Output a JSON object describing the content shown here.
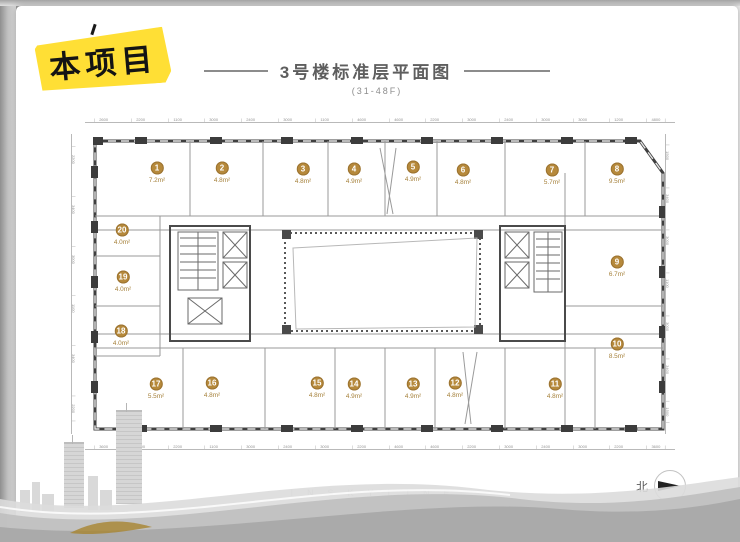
{
  "badge": {
    "label": "本项目"
  },
  "header": {
    "title": "3号楼标准层平面图",
    "subtitle": "(31-48F)"
  },
  "plan": {
    "units": [
      {
        "no": "1",
        "area": "7.2m²",
        "x": 157,
        "y": 169
      },
      {
        "no": "2",
        "area": "4.8m²",
        "x": 222,
        "y": 169
      },
      {
        "no": "3",
        "area": "4.8m²",
        "x": 303,
        "y": 170
      },
      {
        "no": "4",
        "area": "4.9m²",
        "x": 354,
        "y": 170
      },
      {
        "no": "5",
        "area": "4.9m²",
        "x": 413,
        "y": 168
      },
      {
        "no": "6",
        "area": "4.8m²",
        "x": 463,
        "y": 171
      },
      {
        "no": "7",
        "area": "5.7m²",
        "x": 552,
        "y": 171
      },
      {
        "no": "8",
        "area": "9.5m²",
        "x": 617,
        "y": 170
      },
      {
        "no": "9",
        "area": "6.7m²",
        "x": 617,
        "y": 263
      },
      {
        "no": "10",
        "area": "8.5m²",
        "x": 617,
        "y": 345
      },
      {
        "no": "11",
        "area": "4.8m²",
        "x": 555,
        "y": 385
      },
      {
        "no": "12",
        "area": "4.8m²",
        "x": 455,
        "y": 384
      },
      {
        "no": "13",
        "area": "4.9m²",
        "x": 413,
        "y": 385
      },
      {
        "no": "14",
        "area": "4.9m²",
        "x": 354,
        "y": 385
      },
      {
        "no": "15",
        "area": "4.8m²",
        "x": 317,
        "y": 384
      },
      {
        "no": "16",
        "area": "4.8m²",
        "x": 212,
        "y": 384
      },
      {
        "no": "17",
        "area": "5.5m²",
        "x": 156,
        "y": 385
      },
      {
        "no": "18",
        "area": "4.0m²",
        "x": 121,
        "y": 332
      },
      {
        "no": "19",
        "area": "4.0m²",
        "x": 123,
        "y": 278
      },
      {
        "no": "20",
        "area": "4.0m²",
        "x": 122,
        "y": 231
      }
    ],
    "dims_top": [
      "2600",
      "2200",
      "1100",
      "3000",
      "2400",
      "3000",
      "1100",
      "4600",
      "4600",
      "2200",
      "3000",
      "2400",
      "3000",
      "3000",
      "1200",
      "4800"
    ],
    "dims_bottom": [
      "3600",
      "3000",
      "2200",
      "1100",
      "3000",
      "2400",
      "3000",
      "2200",
      "4600",
      "4600",
      "2200",
      "3000",
      "2400",
      "3000",
      "2200",
      "3600"
    ],
    "dims_left": [
      "2200",
      "3400",
      "3000",
      "1100",
      "3400",
      "2200"
    ],
    "dims_right": [
      "1500",
      "3400",
      "3000",
      "1100",
      "3000",
      "3400",
      "1500"
    ]
  },
  "footer": {
    "watermark": "INSKYLINE",
    "north_label": "北"
  },
  "colors": {
    "accent_gold": "#b6893b",
    "badge_yellow": "#ffdf35",
    "wall": "#3f3f3f"
  }
}
